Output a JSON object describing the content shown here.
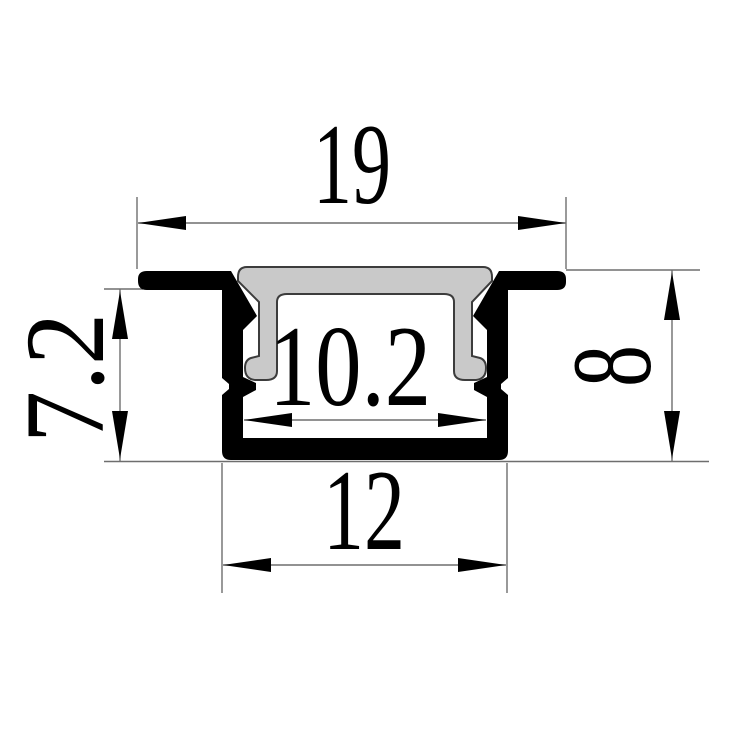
{
  "drawing": {
    "kind": "profile-cross-section",
    "dimensions": {
      "top_width": "19",
      "left_depth": "7.2",
      "inner_width": "10.2",
      "right_height": "8",
      "bottom_width": "12"
    },
    "colors": {
      "background": "#ffffff",
      "body": "#000000",
      "cover_fill": "#c9c9c9",
      "cover_outline": "#3c3c3c",
      "dim_line": "#6e6e6e",
      "ink": "#000000"
    }
  }
}
